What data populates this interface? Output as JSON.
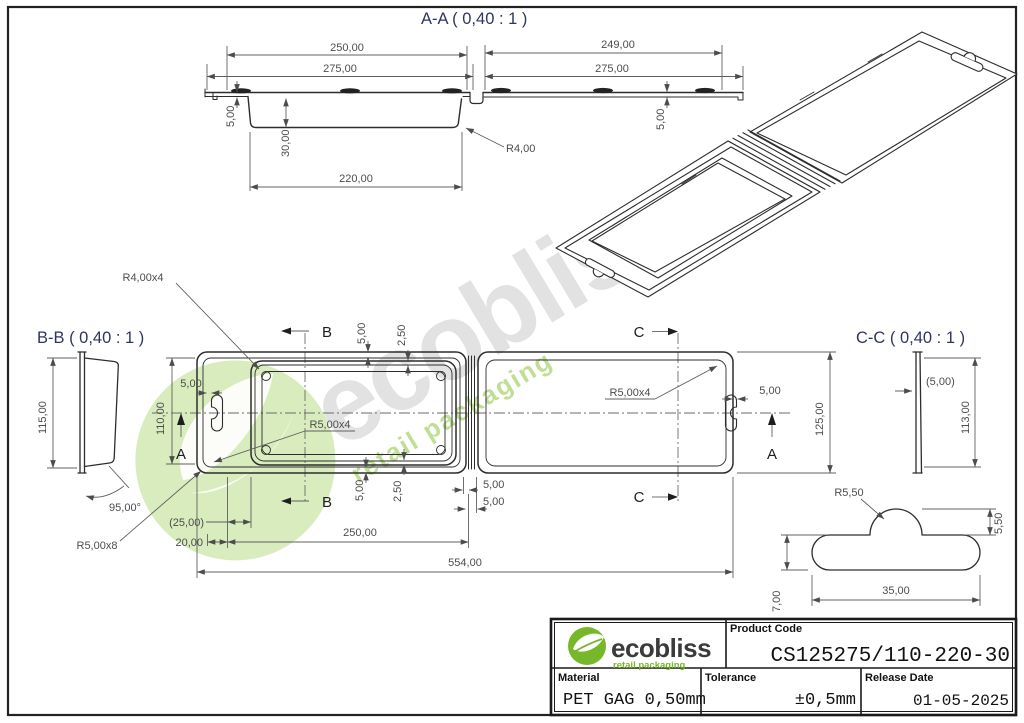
{
  "sheet": {
    "watermark": {
      "word": "ecobliss",
      "tagline": "retail packaging"
    },
    "view_titles": {
      "aa": "A-A  ( 0,40 : 1 )",
      "bb": "B-B  ( 0,40 : 1 )",
      "cc": "C-C  ( 0,40 : 1 )"
    },
    "markers": {
      "a": "A",
      "b": "B",
      "c": "C"
    },
    "dims": {
      "d250": "250,00",
      "d275": "275,00",
      "d249": "249,00",
      "d220": "220,00",
      "d30": "30,00",
      "d5": "5,00",
      "d2_5": "2,50",
      "d110": "110,00",
      "d115": "115,00",
      "d125": "125,00",
      "d113": "113,00",
      "d5_ref": "(5,00)",
      "d25_ref": "(25,00)",
      "d20": "20,00",
      "d554": "554,00",
      "d35": "35,00",
      "d7": "7,00",
      "d5_50": "5,50",
      "a95": "95,00°",
      "r4": "R4,00",
      "r4x4": "R4,00x4",
      "r5x4": "R5,00x4",
      "r5x8": "R5,00x8",
      "r5_50": "R5,50"
    },
    "title_block": {
      "brand": "ecobliss",
      "brand_tagline": "retail packaging",
      "product_code_label": "Product Code",
      "product_code": "CS125275/110-220-30",
      "material_label": "Material",
      "material_value": "PET GAG 0,50mm",
      "tolerance_label": "Tolerance",
      "tolerance_value": "±0,5mm",
      "release_date_label": "Release Date",
      "release_date_value": "01-05-2025"
    },
    "colors": {
      "brand_green": "#76b82a",
      "title_text": "#2e3560",
      "line": "#2d2d2d",
      "dim_text": "#4c4c4c"
    }
  }
}
